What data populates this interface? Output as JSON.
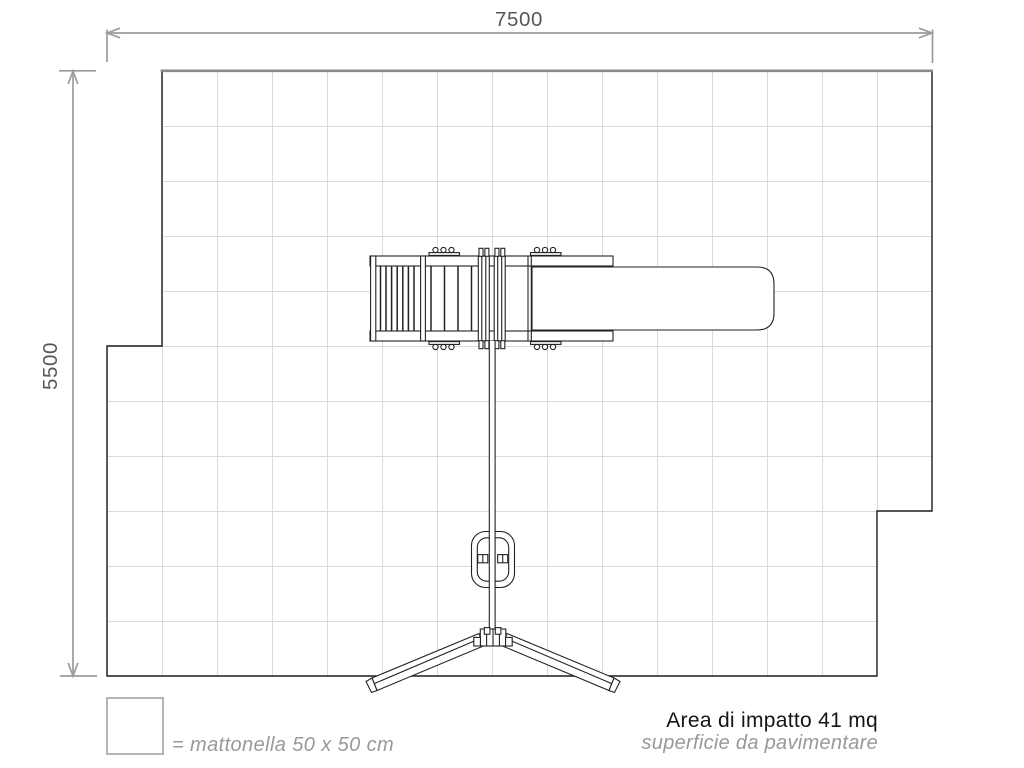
{
  "drawing": {
    "type": "playground-impact-area-plan-top-view"
  },
  "dimensions": {
    "width_label": "7500",
    "height_label": "5500"
  },
  "grid": {
    "columns": 15,
    "rows": 11,
    "tile_px": 55,
    "tile_size": "50 x 50 cm"
  },
  "legend": {
    "label": "= mattonella 50 x 50 cm"
  },
  "impact_area": {
    "label": "Area di impatto 41 mq",
    "sublabel": "superficie da pavimentare",
    "area_mq": "41"
  },
  "colors": {
    "background": "#ffffff",
    "grid_line": "#dadada",
    "area_outline": "#1c1c1c",
    "area_top_edge": "#8a8a8a",
    "dimension_line": "#9b9b9b",
    "dimension_text": "#57585a",
    "dark_text": "#151515",
    "muted_text": "#97999c",
    "legend_box_border": "#b5b5b5",
    "structure_line": "#222222"
  }
}
